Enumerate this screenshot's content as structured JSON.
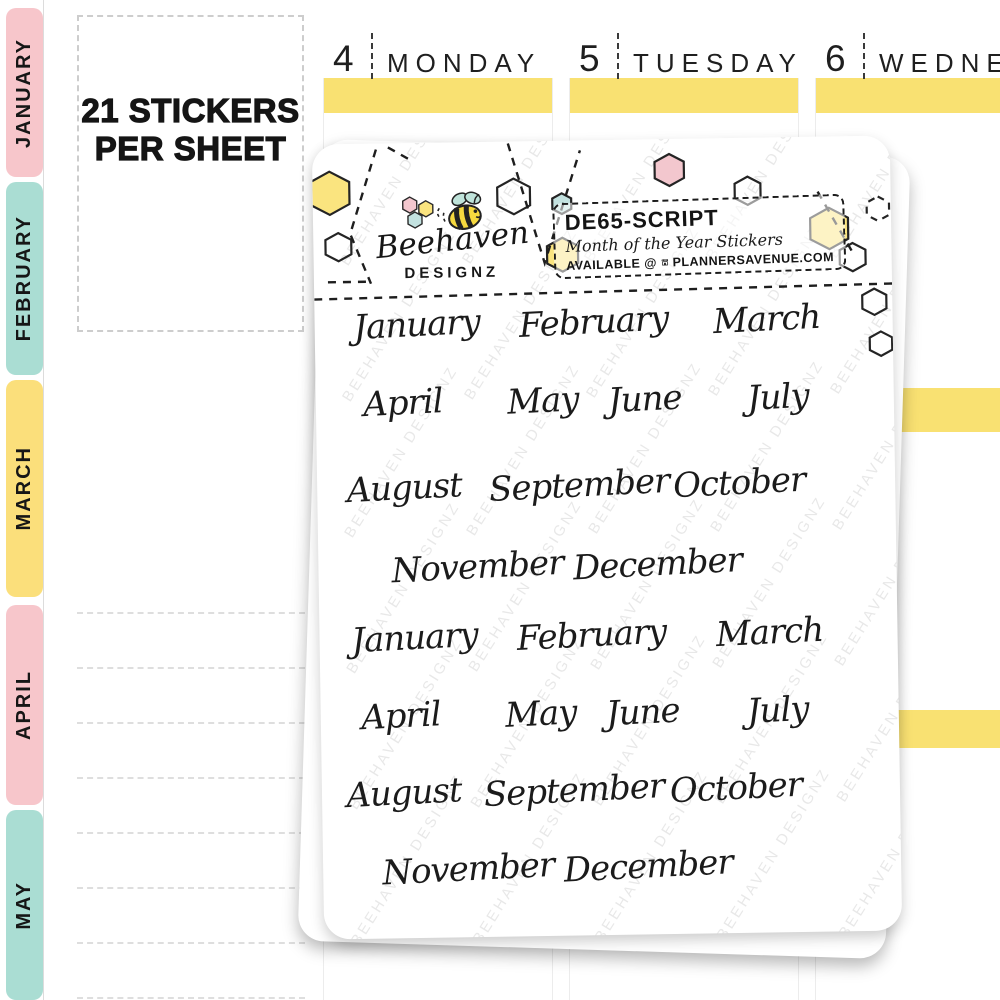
{
  "note": {
    "line1": "21 STICKERS",
    "line2": "PER SHEET"
  },
  "week": {
    "days": [
      {
        "number": "4",
        "name": "MONDAY"
      },
      {
        "number": "5",
        "name": "TUESDAY"
      },
      {
        "number": "6",
        "name": "WEDNESDAY"
      }
    ]
  },
  "tabs": [
    {
      "label": "JANUARY",
      "color": "#f7c6cb"
    },
    {
      "label": "FEBRUARY",
      "color": "#aaddd3"
    },
    {
      "label": "MARCH",
      "color": "#fbdf7b"
    },
    {
      "label": "APRIL",
      "color": "#f7c6cb"
    },
    {
      "label": "MAY",
      "color": "#aaddd3"
    }
  ],
  "sheet": {
    "brand": {
      "name": "Beehaven",
      "subname": "DESIGNZ"
    },
    "info": {
      "sku": "DE65-SCRIPT",
      "product": "Month of the Year Stickers",
      "availability": "AVAILABLE @",
      "store": "PLANNERSAVENUE.COM"
    },
    "watermark": "BEEHAVEN DESIGNZ",
    "month_rows": [
      [
        "January",
        "February",
        "March"
      ],
      [
        "April",
        "May",
        "June",
        "July"
      ],
      [
        "August",
        "September",
        "October"
      ],
      [
        "November",
        "December"
      ],
      [
        "January",
        "February",
        "March"
      ],
      [
        "April",
        "May",
        "June",
        "July"
      ],
      [
        "August",
        "September",
        "October"
      ],
      [
        "November",
        "December"
      ]
    ]
  },
  "colors": {
    "highlight_yellow": "#f9e172",
    "tab_pink": "#f7c6cb",
    "tab_mint": "#aaddd3",
    "tab_yellow": "#fbdf7b",
    "hex_yellow": "#fae47f",
    "hex_pink": "#f3c7ce",
    "hex_blue": "#c3e2e0",
    "bee_yellow": "#f6d93f",
    "wing_mint": "#bfe3da"
  }
}
